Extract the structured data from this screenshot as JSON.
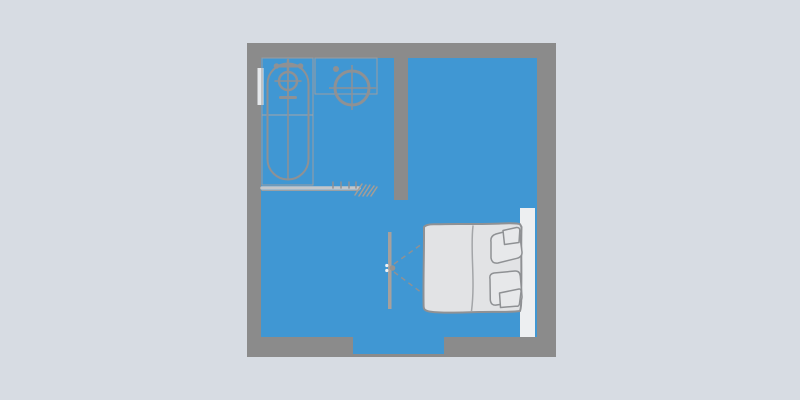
{
  "page": {
    "type": "apartment-floor-plan-illustration",
    "visible_text": ""
  },
  "colors": {
    "page_background": "#d7dce3",
    "wall": "#8b8b8b",
    "floor": "#4097d3",
    "fixture_fill": "#e3e4e6",
    "fixture_fill_light": "#e9eaec",
    "fixture_stroke": "#8f9194",
    "counter_stroke": "#9b9da0",
    "grid_line": "#a3a5a8",
    "bed_fill": "#e2e3e5",
    "pillow_fill": "#e7e8ea",
    "headboard_fill": "#edeff1",
    "door_leaf": "#a7a09c",
    "door_knob": "#98938f",
    "door_knob_dot": "#f2f3f4",
    "swing_dash": "#8f9194",
    "partition_light": "#c3c6ca",
    "partition_dark": "#9aa0a4",
    "hatch": "#a69d95",
    "window_fill": "#e6e9ec"
  },
  "elements": {
    "rooms": [
      "bathroom",
      "main-room",
      "bedroom-area"
    ],
    "fixtures": [
      "outer-walls",
      "interior-wall",
      "entrance-opening",
      "window",
      "bathtub",
      "bathtub-faucet",
      "washbasin",
      "washbasin-tap",
      "shower-partition",
      "door-leaf",
      "door-swing",
      "double-bed",
      "blanket",
      "pillow-top",
      "pillow-bottom",
      "headboard"
    ]
  }
}
